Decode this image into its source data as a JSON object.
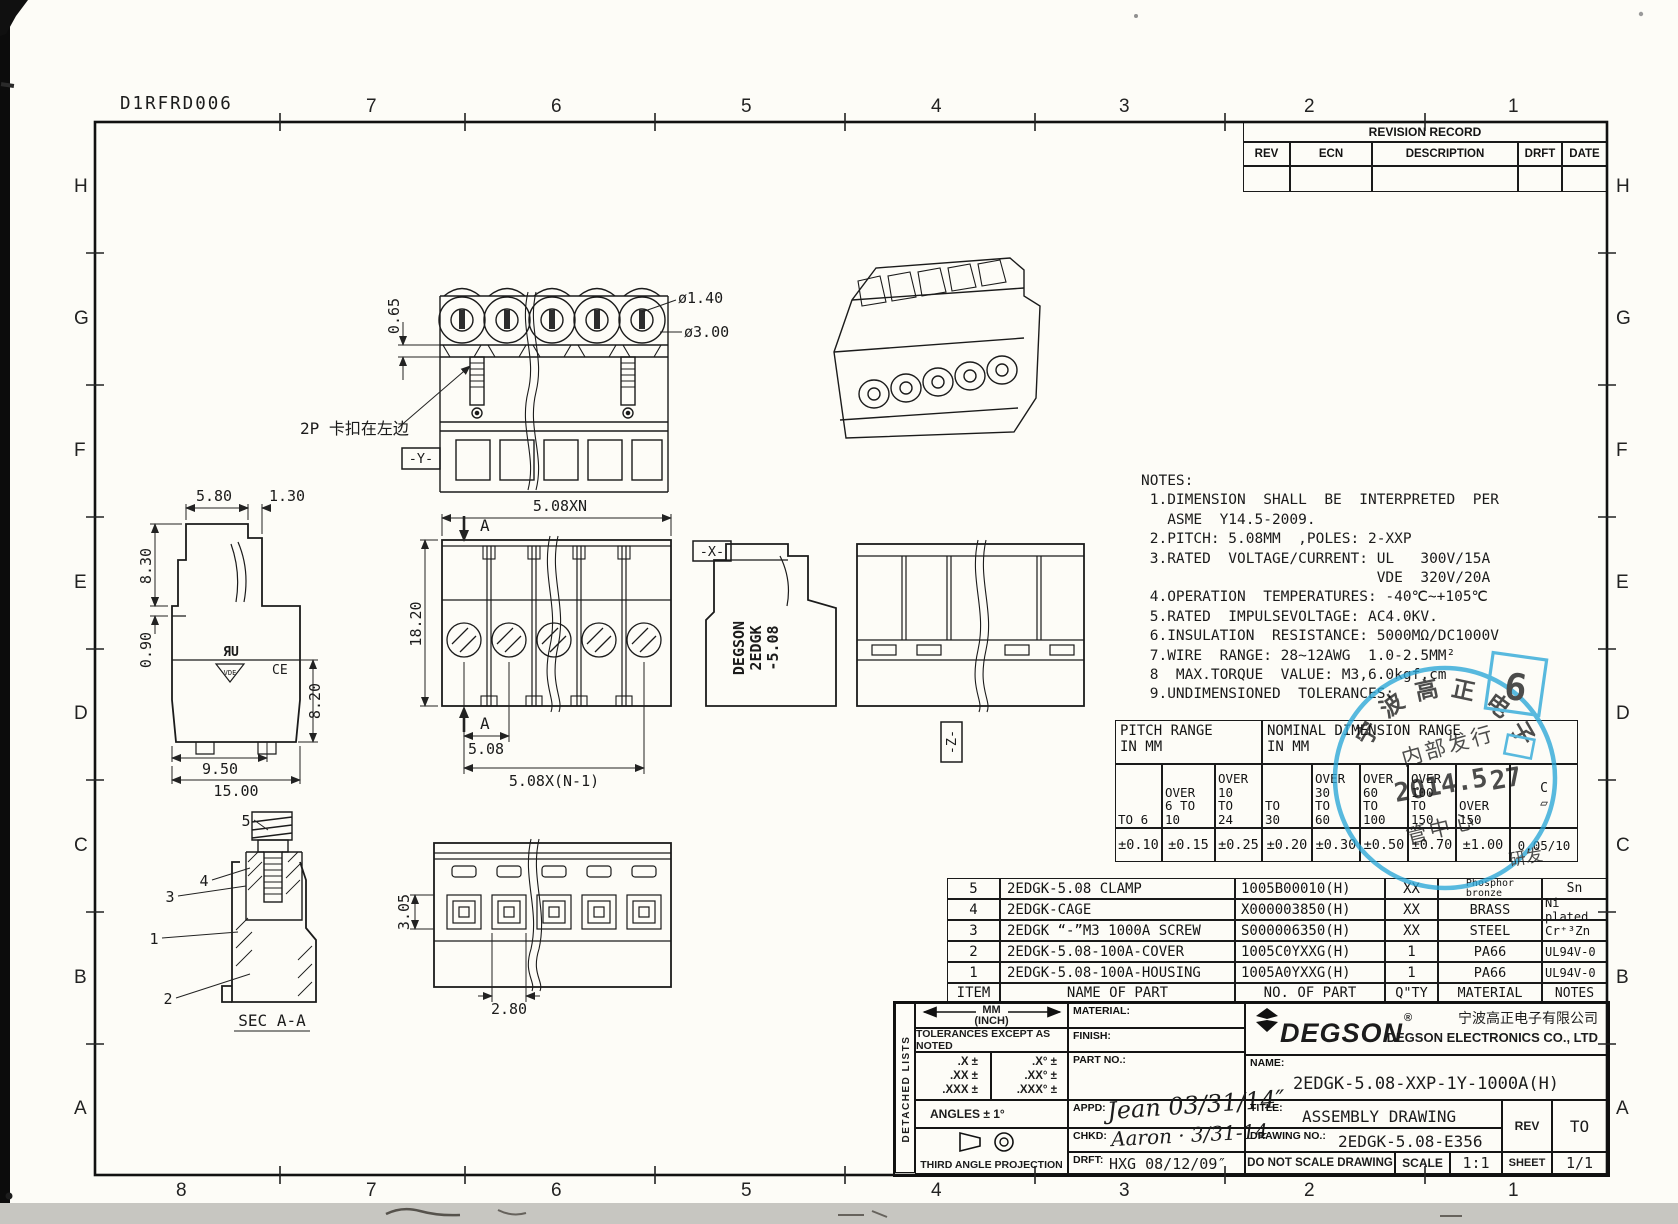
{
  "sheet": {
    "code": "D1RFRD006"
  },
  "grid": {
    "top": [
      "7",
      "6",
      "5",
      "4",
      "3",
      "2",
      "1"
    ],
    "bottom": [
      "8",
      "7",
      "6",
      "5",
      "4",
      "3",
      "2",
      "1"
    ],
    "left": [
      "H",
      "G",
      "F",
      "E",
      "D",
      "C",
      "B",
      "A"
    ],
    "right": [
      "H",
      "G",
      "F",
      "E",
      "D",
      "C",
      "B",
      "A"
    ]
  },
  "revision_record": {
    "title": "REVISION RECORD",
    "columns": [
      "REV",
      "ECN",
      "DESCRIPTION",
      "DRFT",
      "DATE"
    ]
  },
  "notes": {
    "lines": [
      "NOTES:",
      " 1.DIMENSION  SHALL  BE  INTERPRETED  PER",
      "   ASME  Y14.5-2009.",
      " 2.PITCH: 5.08MM  ,POLES: 2-XXP",
      " 3.RATED  VOLTAGE/CURRENT: UL   300V/15A",
      "                           VDE  320V/20A",
      " 4.OPERATION  TEMPERATURES: -40℃~+105℃",
      " 5.RATED  IMPULSEVOLTAGE: AC4.0KV.",
      " 6.INSULATION  RESISTANCE: 5000MΩ/DC1000V",
      " 7.WIRE  RANGE: 28~12AWG  1.0-2.5MM²",
      " 8  MAX.TORQUE  VALUE: M3,6.0kgf.cm",
      " 9.UNDIMENSIONED  TOLERANCES:"
    ]
  },
  "tolerance_table": {
    "pitch_header": "PITCH  RANGE\nIN  MM",
    "nominal_header": "NOMINAL  DIMENSION  RANGE\nIN  MM",
    "columns": [
      "TO 6",
      "OVER\n6 TO\n10",
      "OVER\n10\nTO\n24",
      "TO\n30",
      "OVER\n30\nTO\n60",
      "OVER\n60\nTO\n100",
      "OVER\n100\nTO\n150",
      "OVER\n150",
      "C\n▱"
    ],
    "values": [
      "±0.10",
      "±0.15",
      "±0.25",
      "±0.20",
      "±0.30",
      "±0.50",
      "±0.70",
      "±1.00",
      "0.05/10"
    ]
  },
  "parts_list": {
    "headers": {
      "item": "ITEM",
      "name": "NAME OF PART",
      "no": "NO.  OF  PART",
      "qty": "Q\"TY",
      "material": "MATERIAL",
      "notes": "NOTES"
    },
    "rows": [
      {
        "item": "5",
        "name": "2EDGK-5.08 CLAMP",
        "no": "1005B00010(H)",
        "qty": "XX",
        "material": "Phosphor\nbronze",
        "notes": "Sn"
      },
      {
        "item": "4",
        "name": "2EDGK-CAGE",
        "no": "X000003850(H)",
        "qty": "XX",
        "material": "BRASS",
        "notes": "Ni plated"
      },
      {
        "item": "3",
        "name": "2EDGK “-”M3 1000A SCREW",
        "no": "S000006350(H)",
        "qty": "XX",
        "material": "STEEL",
        "notes": "Cr⁺³Zn"
      },
      {
        "item": "2",
        "name": "2EDGK-5.08-100A-COVER",
        "no": "1005C0YXXG(H)",
        "qty": "1",
        "material": "PA66",
        "notes": "UL94V-0"
      },
      {
        "item": "1",
        "name": "2EDGK-5.08-100A-HOUSING",
        "no": "1005A0YXXG(H)",
        "qty": "1",
        "material": "PA66",
        "notes": "UL94V-0"
      }
    ]
  },
  "title_block": {
    "detached_lists": "DETACHED LISTS",
    "units_mm": "MM",
    "units_inch": "(INCH)",
    "tolerances_note": "TOLERANCES EXCEPT AS NOTED",
    "tol_linear": ".X ±\n.XX ±\n.XXX ±",
    "tol_angular": ".X° ±\n.XX° ±\n.XXX° ±",
    "angles": "ANGLES ± 1°",
    "projection": "THIRD ANGLE PROJECTION",
    "material_label": "MATERIAL:",
    "finish_label": "FINISH:",
    "part_no_label": "PART NO.:",
    "appd_label": "APPD:",
    "appd_value": "Jean 03/31/14″",
    "chkd_label": "CHKD:",
    "chkd_value": "Aaron · 3/31-14",
    "drft_label": "DRFT:",
    "drft_value": "HXG 08/12/09″",
    "brand": "DEGSON",
    "brand_reg": "®",
    "company_cn": "宁波高正电子有限公司",
    "company_en": "DEGSON ELECTRONICS CO., LTD",
    "name_label": "NAME:",
    "name_value": "2EDGK-5.08-XXP-1Y-1000A(H)",
    "title_label": "TITLE:",
    "title_value": "ASSEMBLY  DRAWING",
    "drawing_no_label": "DRAWING NO.:",
    "drawing_no_value": "2EDGK-5.08-E356",
    "do_not_scale": "DO NOT SCALE DRAWING",
    "scale_label": "SCALE",
    "scale_value": "1:1",
    "rev_label": "REV",
    "rev_value": "TO",
    "sheet_label": "SHEET",
    "sheet_value": "1/1"
  },
  "views": {
    "front_top": {
      "dim_065": "0.65",
      "dim_dia140": "ø1.40",
      "dim_dia300": "ø3.00",
      "clip_note": "2P 卡扣在左边",
      "datum_y": "-Y-"
    },
    "front_mid": {
      "dim_pitch_total": "5.08XN",
      "dim_height": "18.20",
      "dim_pitch": "5.08",
      "dim_pitch_n1": "5.08X(N-1)",
      "section_label": "A",
      "datum_x": "-X-"
    },
    "side_left": {
      "dim_580": "5.80",
      "dim_130": "1.30",
      "dim_830": "8.30",
      "dim_090": "0.90",
      "dim_820": "8.20",
      "dim_950": "9.50",
      "dim_1500": "15.00",
      "ul_mark": "ЯU",
      "vde_mark": "VDE",
      "ce_mark": "CE"
    },
    "side_brand": {
      "line1": "DEGSON",
      "line2": "2EDGK",
      "line3": "-5.08"
    },
    "rear": {
      "datum_z": "-Z-"
    },
    "section": {
      "label": "SEC  A-A",
      "balloons": [
        "5",
        "4",
        "3",
        "1",
        "2"
      ]
    },
    "bottom": {
      "dim_305": "3.05",
      "dim_280": "2.80"
    }
  },
  "stamp": {
    "arc_chars": [
      "宁",
      "波",
      "高",
      "正",
      "电",
      "子"
    ],
    "line1": "内部发行",
    "date_main": "2014.5",
    "date_day": "27",
    "line2": "管中心",
    "line3": "研发",
    "badge": "6",
    "color": "#2aa7d8"
  }
}
